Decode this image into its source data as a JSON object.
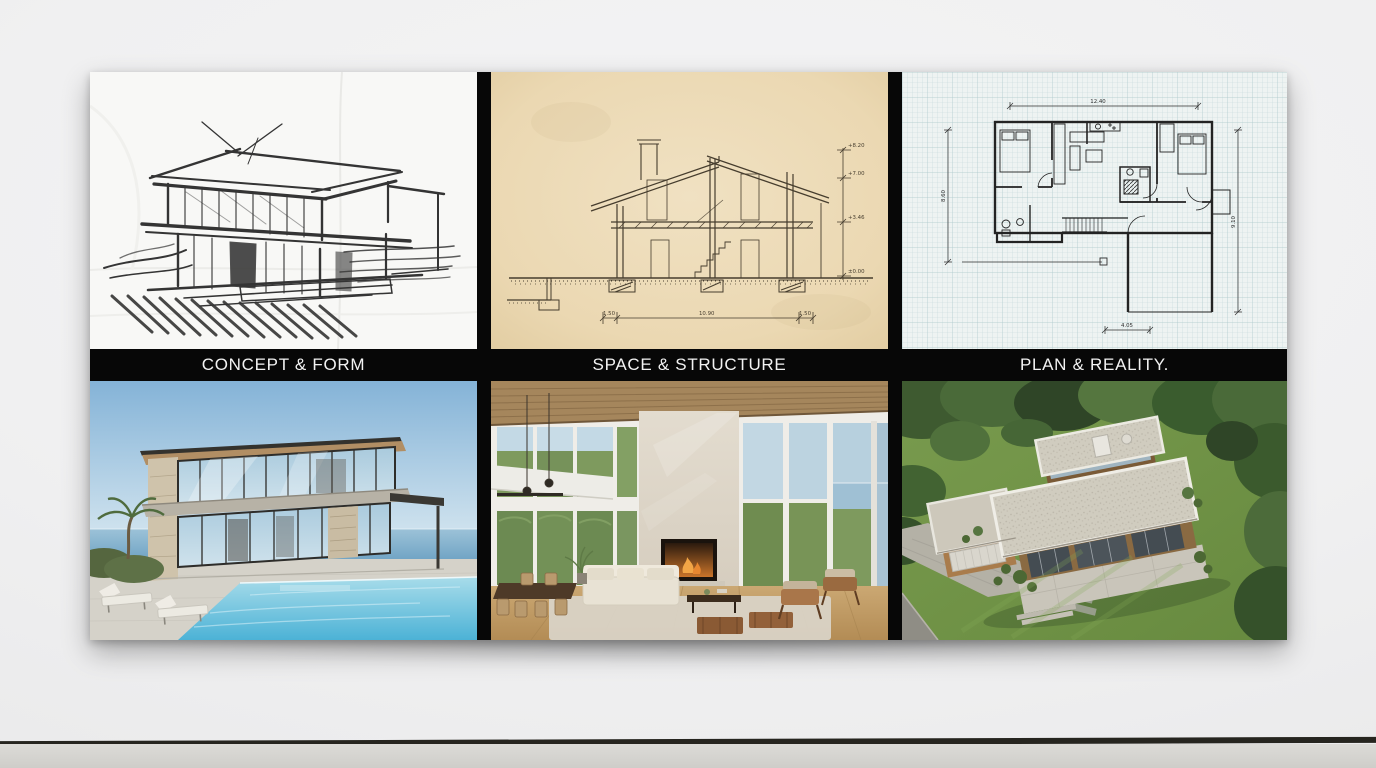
{
  "scene": {
    "setting": "white gallery wall with concrete floor",
    "wall_color": "#f1f1f2",
    "floor_color": "#d6d5d1",
    "baseboard_color": "#26251f",
    "panel_background": "#070707",
    "caption_color": "#f2f2f2"
  },
  "artwork": {
    "columns": [
      {
        "id": "concept-form",
        "caption": "CONCEPT & FORM",
        "top_media": "pencil concept sketch of a modern two-storey flat-roof house on white paper",
        "bottom_media": "photorealistic render of a modern glass villa with infinity pool by the sea"
      },
      {
        "id": "space-structure",
        "caption": "SPACE & STRUCTURE",
        "top_media": "hand-drawn building cross-section with level dimensions on aged cream paper",
        "bottom_media": "photorealistic render of a double-height living room with fireplace and floor-to-ceiling windows"
      },
      {
        "id": "plan-reality",
        "caption": "PLAN & REALITY.",
        "top_media": "hand-drafted floor plan with dimension lines on blue grid paper",
        "bottom_media": "photorealistic aerial render of a flat-roof house with lawn, driveway and trees"
      }
    ],
    "section_annotations": {
      "levels": [
        "+8.20",
        "+7.00",
        "+3.46",
        "±0.00"
      ],
      "spans": [
        "1.50",
        "10.90",
        "1.50"
      ]
    },
    "plan_annotations": {
      "top": "12.40",
      "left": "8.60",
      "right": "9.10",
      "bottom": "4.05"
    }
  }
}
